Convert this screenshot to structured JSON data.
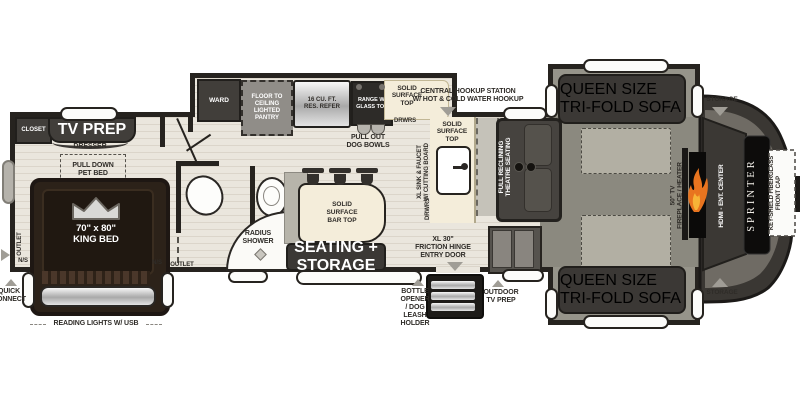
{
  "plan_name": "Sprinter fifth wheel floor plan",
  "colors": {
    "wall": "#26231f",
    "wood_floor": "#eae6dd",
    "carpet": "#8b897f",
    "counter": "#f4edda",
    "flame": "#e8741f"
  },
  "bedroom": {
    "closet": "CLOSET",
    "tv_prep": "TV PREP",
    "dresser": "DRESSER",
    "pet_bed": "PULL DOWN\nPET BED",
    "bed_size": "70\" x 80\"",
    "bed_type": "KING BED",
    "reading_lights": "READING LIGHTS W/ USB",
    "outlet_left": "OUTLET",
    "ns_left": "N/S",
    "ns_right": "N/S",
    "outlet_right": "OUTLET",
    "quick_connect": "QUICK\nCONNECT"
  },
  "bath": {
    "shower": "RADIUS\nSHOWER"
  },
  "kitchen": {
    "ward": "WARD",
    "pantry": "FLOOR TO\nCEILING\nLIGHTED\nPANTRY",
    "refrigerator": "16 CU. FT.\nRES. REFER",
    "range": "RANGE W/\nGLASS TOP",
    "counter_top": "SOLID\nSURFACE\nTOP",
    "drawers_top": "DRWRS",
    "dog_bowls": "PULL OUT\nDOG BOWLS",
    "sink_counter": "SOLID\nSURFACE\nTOP",
    "sink": "XL SINK & FAUCET\nW/ CUTTING BOARD",
    "drawers_side": "DRWRS",
    "bar_top": "SOLID\nSURFACE\nBAR TOP",
    "island_seating": "SEATING + STORAGE"
  },
  "living": {
    "hookup_station": "CENTRAL HOOKUP STATION\nW/ HOT & COLD WATER HOOKUP",
    "theatre_seating": "FULL RECLINING\nTHEATRE SEATING",
    "sofa_top": "QUEEN SIZE\nTRI-FOLD SOFA",
    "sofa_bottom": "QUEEN SIZE\nTRI-FOLD SOFA",
    "storage_top": "STORAGE",
    "storage_bottom": "STORAGE",
    "tv_fireplace": "50\" TV\nFIREPLACE / HEATER",
    "ent_center": "HDMI - ENT. CENTER"
  },
  "exterior": {
    "entry_door": "XL 30\"\nFRICTION HINGE\nENTRY DOOR",
    "bottle_opener": "BOTTLE\nOPENER\n/ DOG\nLEASH\nHOLDER",
    "outdoor_tv": "OUTDOOR\nTV PREP",
    "brand": "SPRINTER",
    "front_cap": "KEY-SHIELD FIBERGLASS\nFRONT CAP"
  }
}
